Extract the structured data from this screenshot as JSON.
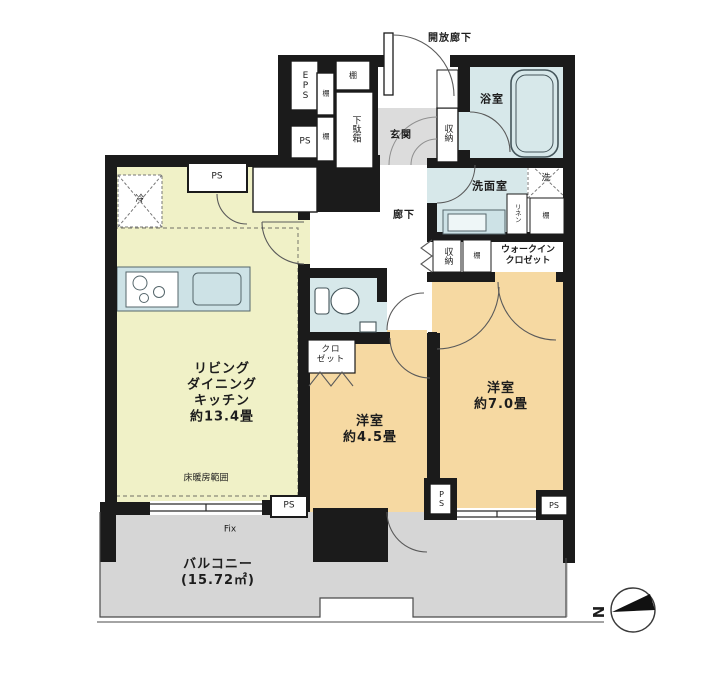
{
  "plan_type": "apartment-floor-plan",
  "labels": {
    "open_corridor": "開放廊下",
    "eps": "EPS",
    "ps": "PS",
    "shelf": "棚",
    "shoe_cabinet": "下駄箱",
    "entrance": "玄関",
    "storage": "収納",
    "bathroom": "浴室",
    "washroom": "洗面室",
    "washer": "洗",
    "linen": "リネン",
    "wic_line1": "ウォークイン",
    "wic_line2": "クロゼット",
    "hallway": "廊下",
    "closet_line1": "クロ",
    "closet_line2": "ゼット",
    "fridge": "冷",
    "floor_heating": "床暖房範囲",
    "fix_window": "Fix",
    "north": "N"
  },
  "rooms": {
    "ldk": {
      "name_lines": [
        "リビング",
        "ダイニング",
        "キッチン"
      ],
      "size": "約13.4畳"
    },
    "bedroom_45": {
      "name": "洋室",
      "size": "約4.5畳"
    },
    "bedroom_70": {
      "name": "洋室",
      "size": "約7.0畳"
    },
    "balcony": {
      "name": "バルコニー",
      "size": "(15.72㎡)"
    }
  },
  "colors": {
    "wall": "#1b1b1b",
    "ldk_floor": "#f0f1c7",
    "bedroom_floor": "#f6d9a2",
    "wet_area_floor": "#d7e8ea",
    "counter": "#cde2e6",
    "balcony_floor": "#d6d6d6",
    "entrance_floor": "#dcdcdc"
  }
}
